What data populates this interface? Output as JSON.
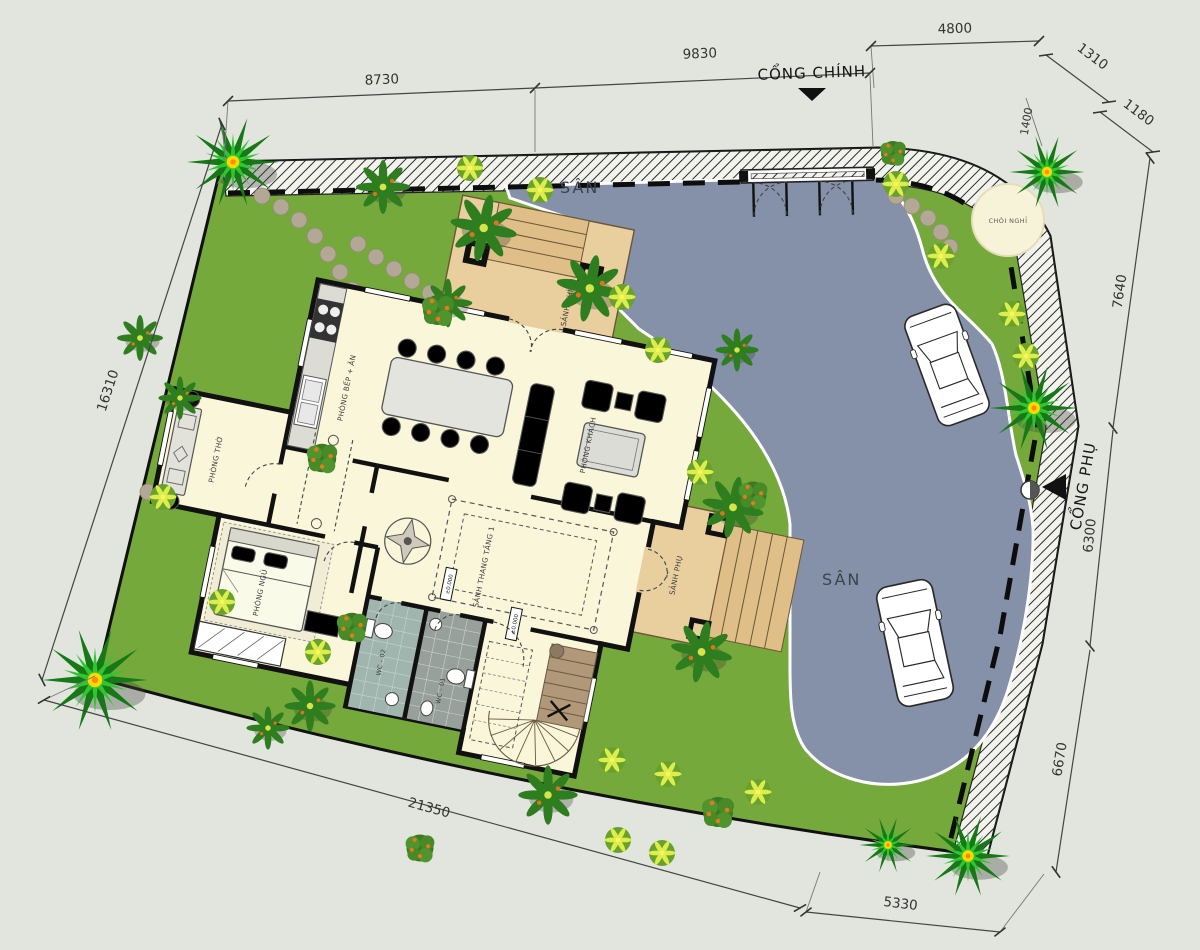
{
  "plan": {
    "gates": {
      "main_label": "CỔNG CHÍNH",
      "side_label": "CỔNG PHỤ"
    },
    "yards": {
      "front": "SÂN",
      "back": "SÂN"
    },
    "gazebo_label": "CHÒI NGHỈ",
    "rooms": {
      "kitchen_dining": "PHÒNG BẾP + ĂN",
      "living": "PHÒNG KHÁCH",
      "worship": "PHÒNG THỜ",
      "bedroom": "PHÒNG NGỦ",
      "wc1": "WC - 01",
      "wc2": "WC - 02",
      "stair_hall": "SẢNH THANG TẦNG 1",
      "main_porch": "SẢNH CHÍNH",
      "side_porch": "SẢNH PHỤ"
    },
    "levels": {
      "ground": "±0.000"
    },
    "dimensions": {
      "top": [
        "8730",
        "9830",
        "4800",
        "1310"
      ],
      "right": [
        "1180",
        "7640",
        "6300",
        "6670"
      ],
      "left": [
        "16310"
      ],
      "bottom": [
        "21350",
        "5330"
      ],
      "corner": "1400"
    },
    "colors": {
      "lawn": "#76a93c",
      "driveway": "#8591a8",
      "house_floor": "#faf6da",
      "porch": "#e9cf9e",
      "walls": "#111111",
      "background": "#e1e5de",
      "wc_floor": "#9aa8a2",
      "stair_wood": "#b19878"
    }
  }
}
